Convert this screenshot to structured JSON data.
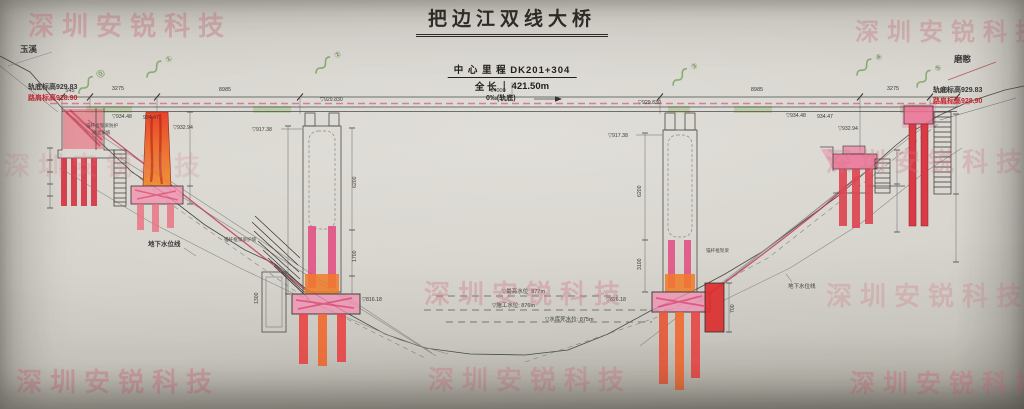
{
  "title": "把边江双线大桥",
  "center_info": {
    "mileage_label": "中 心 里 程",
    "mileage_value": "DK201+304",
    "length_label": "全  长",
    "length_value": "421.50m",
    "gradient_note": "0‰(轨底)"
  },
  "directions": {
    "left": "玉溪",
    "right": "磨憨"
  },
  "elevations_left": {
    "rail": "轨底标高929.83",
    "shoulder": "路肩标高928.90"
  },
  "elevations_right": {
    "rail": "轨底标高929.83",
    "shoulder": "路肩标高928.90"
  },
  "top_dims": [
    "545",
    "3275",
    "8985",
    "14000",
    "8985",
    "3275",
    "545"
  ],
  "vertical_dims": {
    "pier2_upper": "6200",
    "pier2_lower": "1700",
    "pier2_box": "1300",
    "pier3_upper": "6200",
    "pier3_lower": "3100",
    "right_wall": "700"
  },
  "spot_elevations": {
    "deck_1": "▽934.48",
    "deck_2": "934.47",
    "deck_3": "▽932.94",
    "deck_4": "▽929.830",
    "pier2_top": "▽917.38",
    "pier2_base": "▽816.18",
    "pier3_top": "▽917.38",
    "pier3_base": "▽826.18",
    "deck_5": "▽929.830",
    "deck_6": "▽934.48",
    "deck_7": "934.47",
    "deck_8": "▽932.94"
  },
  "water_levels": {
    "high": "▽最高水位: 877m",
    "construction": "▽施工水位: 876m",
    "dead": "▽水库死水位: 875m"
  },
  "ground_water": {
    "left": "地下水位线",
    "right": "地下水位线"
  },
  "slope_notes": {
    "left_1": "锚杆框架梁防护",
    "left_2": "喷混护坡",
    "mid": "锚杆框架梁护坡",
    "right": "锚杆框架梁"
  },
  "green_marks": [
    {
      "num": "⓪"
    },
    {
      "num": "①"
    },
    {
      "num": "②"
    },
    {
      "num": "③"
    },
    {
      "num": "④"
    },
    {
      "num": "⑤"
    }
  ],
  "watermark": {
    "text": "深圳安锐科技",
    "color": "#cf7b88"
  },
  "colors": {
    "paper": "#d5d2cb",
    "line": "#3f3f3f",
    "pier_red": "#dd4350",
    "pier_orange": "#f07a28",
    "pier_pink": "#ef7fa0",
    "marker_green": "#7da95f",
    "rail_dash_pink": "#d56f8a",
    "red_text": "#c0242e"
  }
}
